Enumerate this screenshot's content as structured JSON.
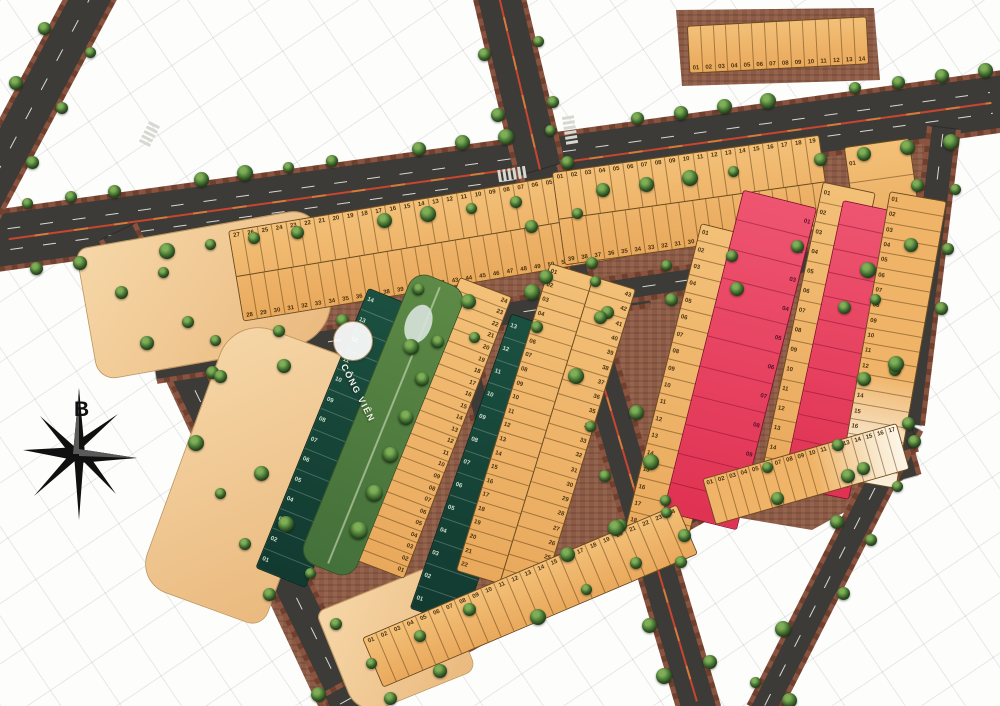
{
  "compass": {
    "north_label": "B"
  },
  "colors": {
    "lot_orange": "#eeb064",
    "lot_red": "#e8425e",
    "lot_dark_green": "#174539",
    "ct_tan": "#f0c691",
    "road_asphalt": "#3c3b37",
    "brick_edge": "#8a5340",
    "park_green": "#547f3e",
    "landmark_brown": "#9c7b50",
    "label_circle_bg": "#f8f5ec"
  },
  "road_labels": [
    {
      "id": "dt-603",
      "text": "ĐT 603",
      "arrow": "left"
    },
    {
      "id": "nga-4-dien-ngoc",
      "text": "NGÃ 4 ĐIỆN NGỌC",
      "arrow": "left"
    },
    {
      "id": "kdt-so-3",
      "text": "KĐT SỐ 3",
      "arrow": "up"
    }
  ],
  "landmarks": [
    {
      "id": "lang-dh-da-nang",
      "label": "LÀNG ĐH ĐÀ NẴNG",
      "icon": "graduation-cap-icon"
    },
    {
      "id": "kdt-so-4",
      "label": "KĐT SỐ 4",
      "icon": "building-icon"
    },
    {
      "id": "bai-tam-viem-dong",
      "label": "BÃI TẮM VIÊM ĐÔNG",
      "icon": "beach-umbrella-icon",
      "arrow": "right"
    },
    {
      "id": "kdc-hien-huu",
      "label": "KDC HIỆN HỮU",
      "icon": "house-icon"
    },
    {
      "id": "khu-chinh-tri",
      "label": "KHU CHÍNH TRỊ",
      "icon": "government-icon"
    },
    {
      "id": "cho-dien-ngoc",
      "label": "CHỢ ĐIỆN NGỌC",
      "icon": "shopping-cart-icon"
    },
    {
      "id": "kdt-so-9-south",
      "label": "KĐT SỐ 9",
      "icon": "building-icon"
    },
    {
      "id": "kdt-so-9-east",
      "label": "KĐT SỐ 9",
      "icon": "building-icon"
    }
  ],
  "parks": [
    {
      "id": "cong-vien-west",
      "label": "CÔNG VIÊN",
      "icon": "trees-icon"
    },
    {
      "id": "cong-vien-east",
      "label": "CÔNG VIÊN",
      "icon": "trees-icon"
    }
  ],
  "blocks": [
    {
      "id": "ct1",
      "name": "CT1",
      "area": "2357"
    },
    {
      "id": "ct2",
      "name": "CT2",
      "area": "3553"
    },
    {
      "id": "ct3",
      "name": "CT3",
      "area": "768"
    },
    {
      "id": "bt1",
      "name": "BT1",
      "area": "2016",
      "lots": "14"
    },
    {
      "id": "bt2",
      "name": "BT2",
      "area": "1973",
      "lots": "11"
    },
    {
      "id": "bt3",
      "name": "BT3",
      "area": "1779",
      "lots": "13"
    },
    {
      "id": "lk1",
      "name": "LK1",
      "area": "6043",
      "lots": "55"
    },
    {
      "id": "lk2",
      "name": "LK2",
      "area": "482",
      "lots": "03"
    },
    {
      "id": "lk3",
      "name": "LK3",
      "area": "1976",
      "lots": "24"
    },
    {
      "id": "lk4",
      "name": "LK4",
      "area": "4097",
      "lots": "43"
    },
    {
      "id": "lk5",
      "name": "LK5",
      "area": "2340",
      "lots": "24"
    },
    {
      "id": "lk6",
      "name": "LK6",
      "area": "4284",
      "lots": "39"
    },
    {
      "id": "lk7",
      "name": "LK7",
      "area": "2235",
      "lots": "19"
    },
    {
      "id": "lk8",
      "name": "LK8",
      "area": "1533",
      "lots": "15"
    },
    {
      "id": "lk9",
      "name": "LK9",
      "area": "1641",
      "lots": "17"
    },
    {
      "id": "lk10",
      "name": "LK10",
      "area": "1409",
      "lots": "14"
    },
    {
      "id": "tdc1",
      "name": "TDC1",
      "area": "2341",
      "lots": "19"
    },
    {
      "id": "tdc2",
      "name": "TDC2",
      "area": "1470",
      "lots": "12"
    }
  ],
  "dimension_notes": [
    {
      "id": "lk1-top",
      "text": "28 X 5M = 140.00"
    },
    {
      "id": "lk1-bottom",
      "text": "27 X 5M = 135.00"
    },
    {
      "id": "lk6-top",
      "text": "17 X 5M = 85.00"
    },
    {
      "id": "lk6-bottom",
      "text": "18 X 5M = 90.00"
    }
  ]
}
